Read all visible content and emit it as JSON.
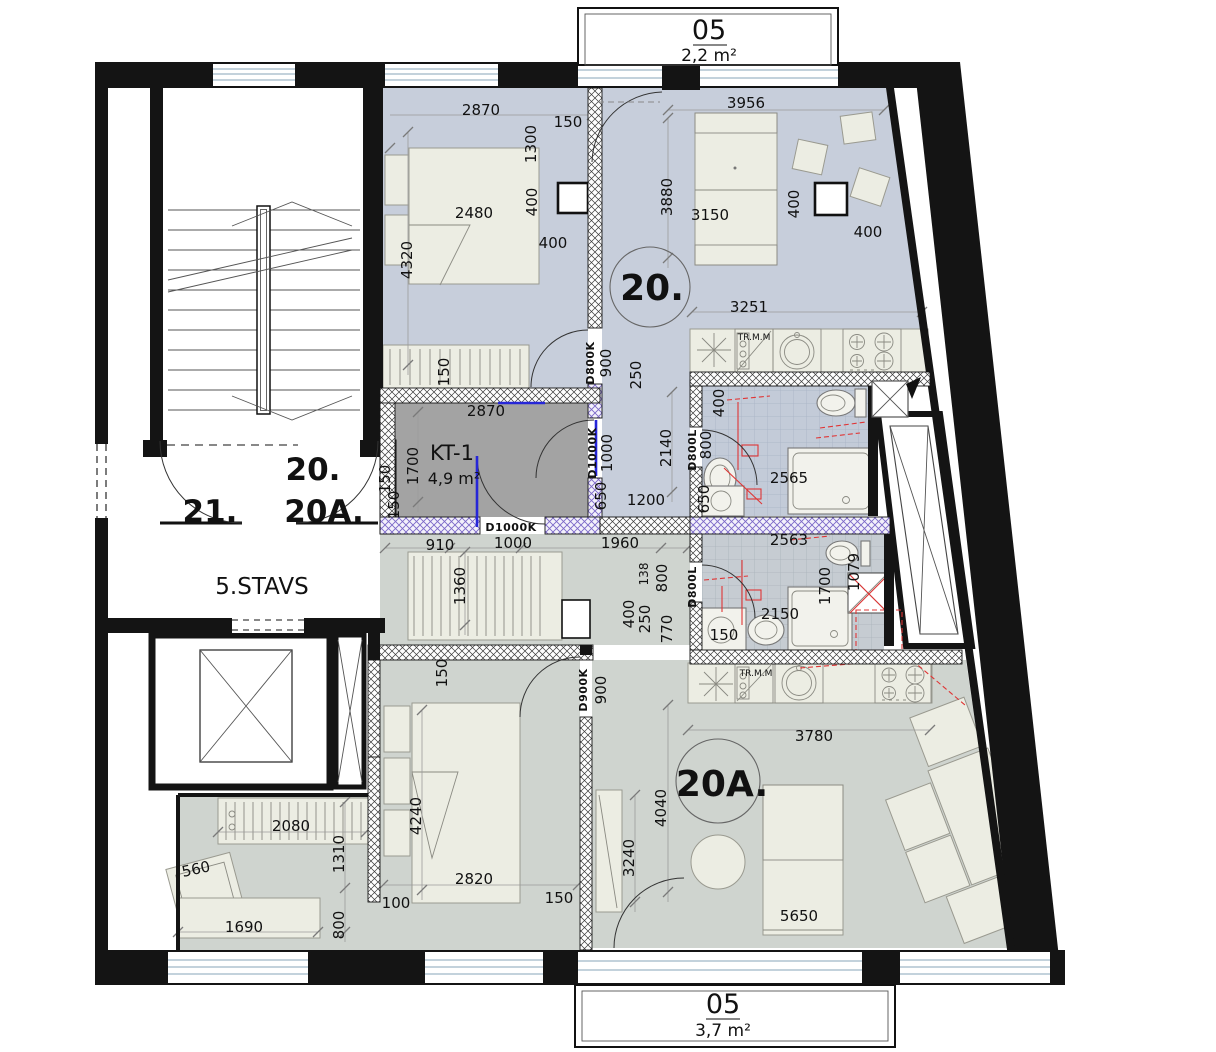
{
  "plan": {
    "floor_label": "5.STAVS",
    "unit_numbers": [
      "20.",
      "20A.",
      "21."
    ],
    "rooms": [
      {
        "name": "KT-1",
        "area": "4,9 m²"
      }
    ],
    "balconies": [
      {
        "number": "05",
        "area": "2,2 m²"
      },
      {
        "number": "05",
        "area": "3,7 m²"
      }
    ],
    "door_codes": [
      "D800K",
      "D1000K",
      "D800L",
      "D800L",
      "D900K",
      "D1000K"
    ],
    "colors": {
      "unit20_fill": "#c7cedb",
      "unit20a_fill": "#cfd4cf",
      "kt1_fill": "#a3a3a3",
      "annotation_red": "#e03535",
      "door_blue": "#2626d8"
    }
  },
  "label_groups": {
    "units": [
      {
        "t": "20.",
        "x": 652,
        "y": 300,
        "r": 0,
        "c": "unit"
      },
      {
        "t": "20A.",
        "x": 722,
        "y": 796,
        "r": 0,
        "c": "unit"
      },
      {
        "t": "21.",
        "x": 210,
        "y": 522,
        "r": 0,
        "c": "unit-sm"
      },
      {
        "t": "20.",
        "x": 313,
        "y": 480,
        "r": 0,
        "c": "unit-sm"
      },
      {
        "t": "20A.",
        "x": 324,
        "y": 522,
        "r": 0,
        "c": "unit-sm"
      }
    ],
    "floor": [
      {
        "t": "5.STAVS",
        "x": 262,
        "y": 594,
        "r": 0,
        "c": "floor"
      }
    ],
    "rooms": [
      {
        "t": "KT-1",
        "x": 452,
        "y": 460,
        "r": 0,
        "c": "room-name"
      },
      {
        "t": "4,9 m²",
        "x": 454,
        "y": 484,
        "r": 0,
        "c": "room-area"
      }
    ],
    "balconies": [
      {
        "t": "05",
        "x": 709,
        "y": 39,
        "r": 0,
        "c": "balcony-no"
      },
      {
        "t": "2,2 m²",
        "x": 709,
        "y": 61,
        "r": 0,
        "c": "balcony-area"
      },
      {
        "t": "05",
        "x": 723,
        "y": 1013,
        "r": 0,
        "c": "balcony-no"
      },
      {
        "t": "3,7 m²",
        "x": 723,
        "y": 1036,
        "r": 0,
        "c": "balcony-area"
      }
    ],
    "doors": [
      {
        "t": "D800K",
        "x": 594,
        "y": 363,
        "r": -90,
        "c": "door"
      },
      {
        "t": "D1000K",
        "x": 596,
        "y": 453,
        "r": -90,
        "c": "door"
      },
      {
        "t": "D800L",
        "x": 696,
        "y": 450,
        "r": -90,
        "c": "door"
      },
      {
        "t": "D800L",
        "x": 696,
        "y": 587,
        "r": -90,
        "c": "door"
      },
      {
        "t": "D900K",
        "x": 587,
        "y": 690,
        "r": -90,
        "c": "door"
      },
      {
        "t": "D1000K",
        "x": 511,
        "y": 531,
        "r": 0,
        "c": "door"
      }
    ],
    "kitchens": [
      {
        "t": "TR.M.M",
        "x": 754,
        "y": 340,
        "r": 0,
        "c": "tiny"
      },
      {
        "t": "TR.M.M",
        "x": 756,
        "y": 676,
        "r": 0,
        "c": "tiny"
      }
    ],
    "dims": [
      {
        "t": "2870",
        "x": 481,
        "y": 115,
        "r": 0,
        "c": "dim"
      },
      {
        "t": "1300",
        "x": 536,
        "y": 144,
        "r": -90,
        "c": "dim"
      },
      {
        "t": "150",
        "x": 568,
        "y": 127,
        "r": 0,
        "c": "dim"
      },
      {
        "t": "400",
        "x": 537,
        "y": 202,
        "r": -90,
        "c": "dim"
      },
      {
        "t": "400",
        "x": 553,
        "y": 248,
        "r": 0,
        "c": "dim"
      },
      {
        "t": "2480",
        "x": 474,
        "y": 218,
        "r": 0,
        "c": "dim"
      },
      {
        "t": "4320",
        "x": 412,
        "y": 260,
        "r": -90,
        "c": "dim"
      },
      {
        "t": "150",
        "x": 449,
        "y": 372,
        "r": -90,
        "c": "dim"
      },
      {
        "t": "2870",
        "x": 486,
        "y": 416,
        "r": 0,
        "c": "dim"
      },
      {
        "t": "1700",
        "x": 418,
        "y": 466,
        "r": -90,
        "c": "dim"
      },
      {
        "t": "150",
        "x": 399,
        "y": 505,
        "r": -90,
        "c": "dim"
      },
      {
        "t": "150",
        "x": 390,
        "y": 479,
        "r": -90,
        "c": "dim"
      },
      {
        "t": "3956",
        "x": 746,
        "y": 108,
        "r": 0,
        "c": "dim"
      },
      {
        "t": "3880",
        "x": 672,
        "y": 197,
        "r": -90,
        "c": "dim"
      },
      {
        "t": "3150",
        "x": 710,
        "y": 220,
        "r": 0,
        "c": "dim"
      },
      {
        "t": "400",
        "x": 799,
        "y": 204,
        "r": -90,
        "c": "dim"
      },
      {
        "t": "400",
        "x": 868,
        "y": 237,
        "r": 0,
        "c": "dim"
      },
      {
        "t": "3251",
        "x": 749,
        "y": 312,
        "r": 0,
        "c": "dim"
      },
      {
        "t": "900",
        "x": 611,
        "y": 363,
        "r": -90,
        "c": "dim"
      },
      {
        "t": "250",
        "x": 641,
        "y": 375,
        "r": -90,
        "c": "dim"
      },
      {
        "t": "2140",
        "x": 671,
        "y": 448,
        "r": -90,
        "c": "dim"
      },
      {
        "t": "1000",
        "x": 612,
        "y": 453,
        "r": -90,
        "c": "dim"
      },
      {
        "t": "650",
        "x": 606,
        "y": 496,
        "r": -90,
        "c": "dim"
      },
      {
        "t": "1200",
        "x": 646,
        "y": 505,
        "r": 0,
        "c": "dim"
      },
      {
        "t": "400",
        "x": 724,
        "y": 403,
        "r": -90,
        "c": "dim"
      },
      {
        "t": "800",
        "x": 711,
        "y": 445,
        "r": -90,
        "c": "dim"
      },
      {
        "t": "650",
        "x": 709,
        "y": 499,
        "r": -90,
        "c": "dim"
      },
      {
        "t": "2565",
        "x": 789,
        "y": 483,
        "r": 0,
        "c": "dim"
      },
      {
        "t": "2563",
        "x": 789,
        "y": 545,
        "r": 0,
        "c": "dim"
      },
      {
        "t": "1079",
        "x": 859,
        "y": 572,
        "r": -90,
        "c": "dim"
      },
      {
        "t": "1700",
        "x": 830,
        "y": 586,
        "r": -90,
        "c": "dim"
      },
      {
        "t": "2150",
        "x": 780,
        "y": 619,
        "r": 0,
        "c": "dim"
      },
      {
        "t": "150",
        "x": 724,
        "y": 640,
        "r": 0,
        "c": "dim"
      },
      {
        "t": "910",
        "x": 440,
        "y": 550,
        "r": 0,
        "c": "dim"
      },
      {
        "t": "1000",
        "x": 513,
        "y": 548,
        "r": 0,
        "c": "dim"
      },
      {
        "t": "1960",
        "x": 620,
        "y": 548,
        "r": 0,
        "c": "dim"
      },
      {
        "t": "1360",
        "x": 465,
        "y": 586,
        "r": -90,
        "c": "dim"
      },
      {
        "t": "138",
        "x": 648,
        "y": 574,
        "r": -90,
        "c": "dim-s"
      },
      {
        "t": "800",
        "x": 667,
        "y": 578,
        "r": -90,
        "c": "dim"
      },
      {
        "t": "400",
        "x": 634,
        "y": 614,
        "r": -90,
        "c": "dim"
      },
      {
        "t": "250",
        "x": 650,
        "y": 619,
        "r": -90,
        "c": "dim"
      },
      {
        "t": "770",
        "x": 672,
        "y": 629,
        "r": -90,
        "c": "dim"
      },
      {
        "t": "150",
        "x": 447,
        "y": 673,
        "r": -90,
        "c": "dim"
      },
      {
        "t": "900",
        "x": 606,
        "y": 690,
        "r": -90,
        "c": "dim"
      },
      {
        "t": "3780",
        "x": 814,
        "y": 741,
        "r": 0,
        "c": "dim"
      },
      {
        "t": "4040",
        "x": 666,
        "y": 808,
        "r": -90,
        "c": "dim"
      },
      {
        "t": "3240",
        "x": 634,
        "y": 858,
        "r": -90,
        "c": "dim"
      },
      {
        "t": "5650",
        "x": 799,
        "y": 921,
        "r": 0,
        "c": "dim"
      },
      {
        "t": "2820",
        "x": 474,
        "y": 884,
        "r": 0,
        "c": "dim"
      },
      {
        "t": "150",
        "x": 559,
        "y": 903,
        "r": 0,
        "c": "dim"
      },
      {
        "t": "100",
        "x": 396,
        "y": 908,
        "r": 0,
        "c": "dim"
      },
      {
        "t": "4240",
        "x": 421,
        "y": 816,
        "r": -90,
        "c": "dim"
      },
      {
        "t": "1310",
        "x": 344,
        "y": 854,
        "r": -90,
        "c": "dim"
      },
      {
        "t": "800",
        "x": 344,
        "y": 925,
        "r": -90,
        "c": "dim"
      },
      {
        "t": "560",
        "x": 197,
        "y": 874,
        "r": -12,
        "c": "dim"
      },
      {
        "t": "2080",
        "x": 291,
        "y": 831,
        "r": 0,
        "c": "dim"
      },
      {
        "t": "1690",
        "x": 244,
        "y": 932,
        "r": 0,
        "c": "dim"
      }
    ]
  }
}
